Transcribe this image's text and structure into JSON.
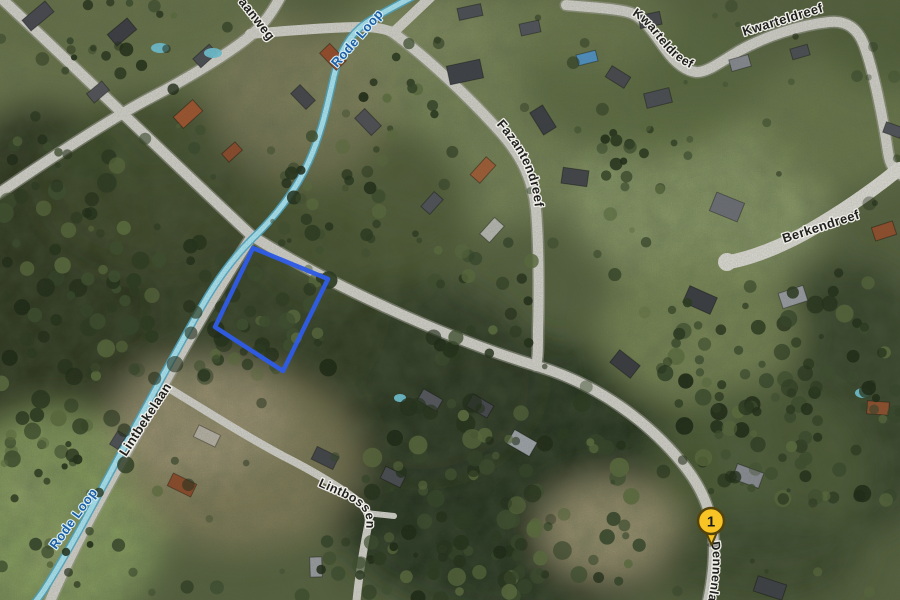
{
  "map": {
    "labels": {
      "aanweg": "aanweg",
      "rode_loop_top": "Rode Loop",
      "rode_loop_bottom": "Rode Loop",
      "kwarteldreef_1": "Kwarteldreef",
      "kwarteldreef_2": "Kwarteldreef",
      "fazantendreef": "Fazantendreef",
      "berkendreef": "Berkendreef",
      "lintbekelaan": "Lintbekelaan",
      "lintbossen": "Lintbossen",
      "dennenlaan": "Dennenlaan"
    },
    "marker": {
      "label": "1",
      "fill": "#F7C325",
      "border": "#54430A"
    },
    "parcel": {
      "outline_color": "#2F5CE5"
    },
    "water": {
      "stroke": "#A6E0EE",
      "casing": "#4FA6C4",
      "label_color": "#1D5FA6"
    }
  }
}
